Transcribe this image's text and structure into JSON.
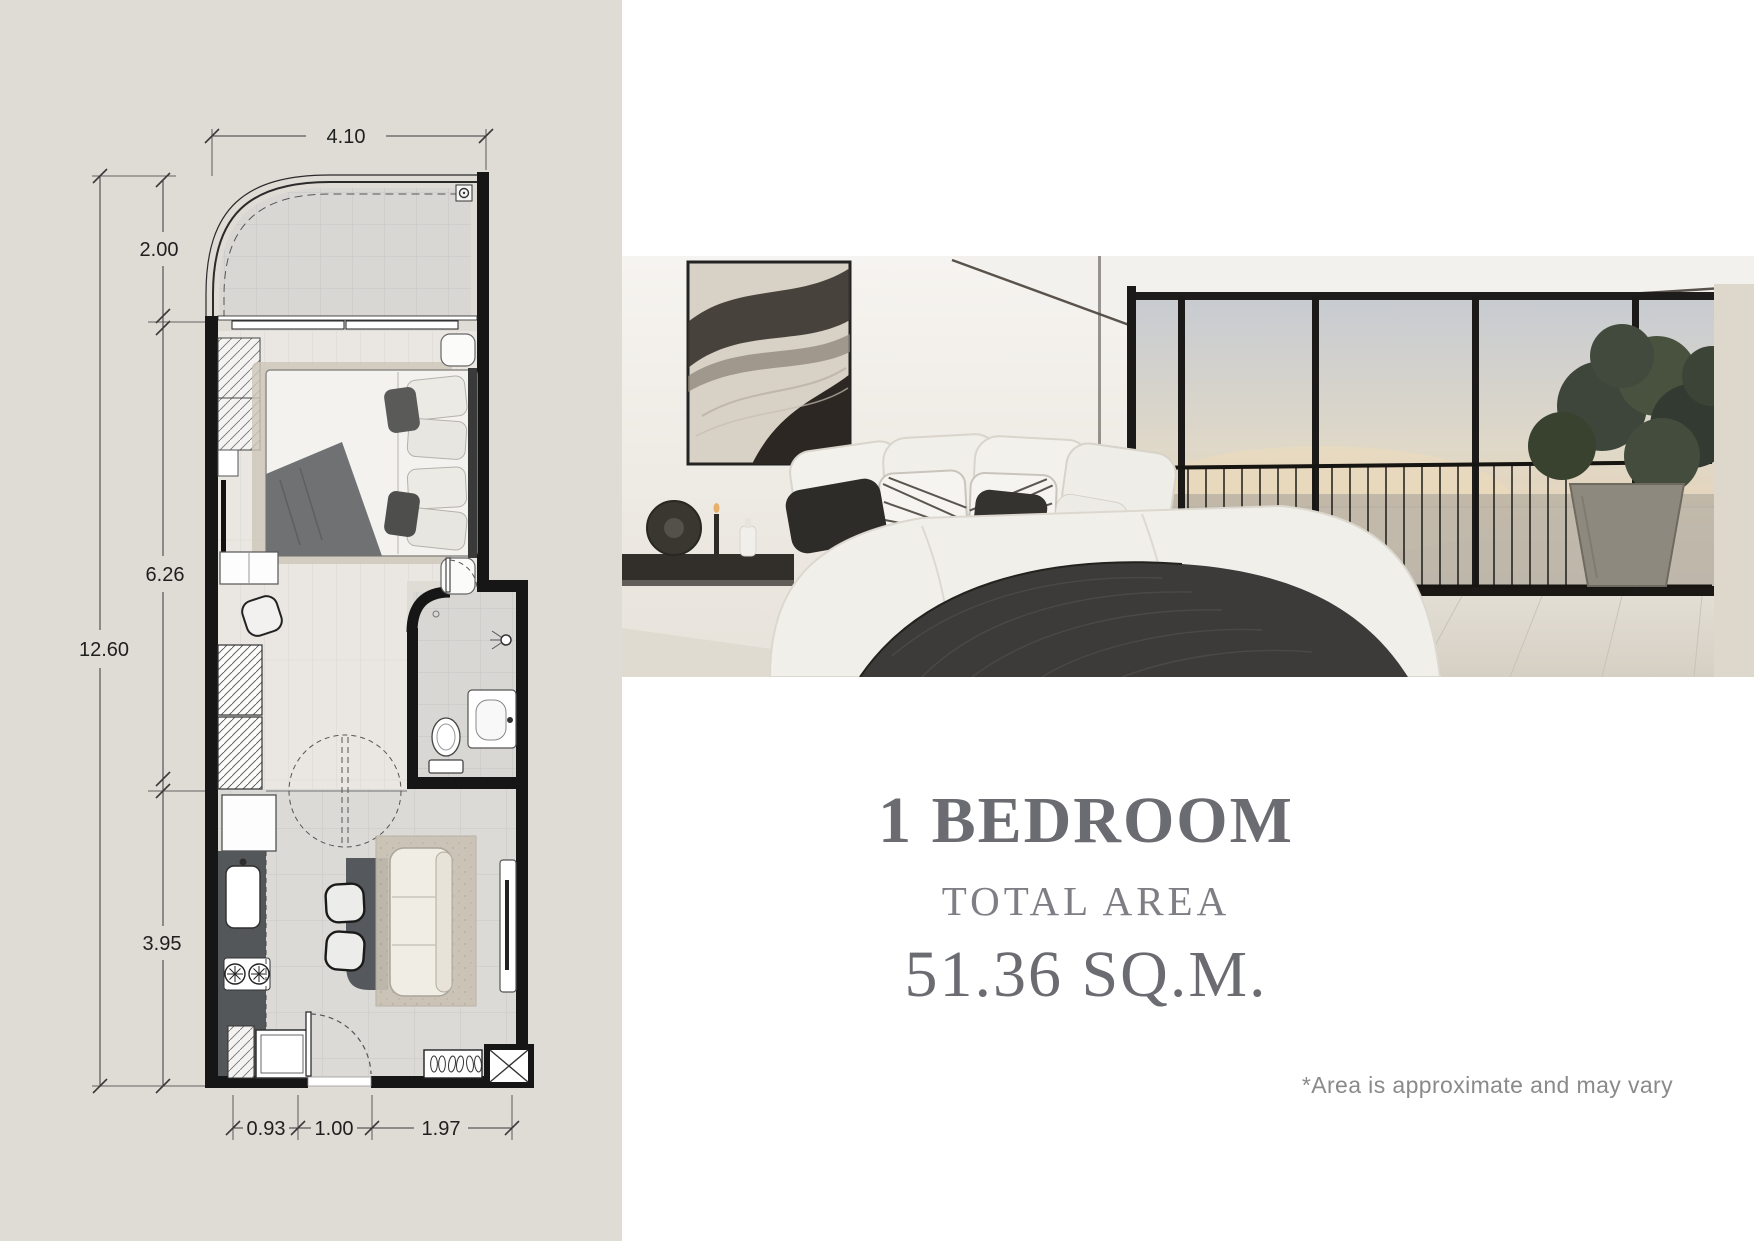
{
  "panel": {
    "bg": "#dfdbd5"
  },
  "plan": {
    "dims": {
      "top": "4.10",
      "total_height": "12.60",
      "balcony_depth": "2.00",
      "bedroom_depth": "6.26",
      "living_depth": "3.95",
      "bottom_a": "0.93",
      "bottom_b": "1.00",
      "bottom_c": "1.97"
    }
  },
  "info": {
    "title": "1 BEDROOM",
    "subtitle": "TOTAL AREA",
    "area": "51.36 SQ.M.",
    "disclaimer": "*Area is approximate and may vary"
  },
  "colors": {
    "headline": "#6b6b72",
    "subtitle": "#7e7e85",
    "disclaimer": "#8a8a8a",
    "panel_bg": "#dfdbd5",
    "wall": "#161616"
  },
  "icons": [
    "ac-unit-icon",
    "bed-icon",
    "pillow-icon",
    "nightstand-icon",
    "wardrobe-icon",
    "tv-icon",
    "desk-icon",
    "chair-icon",
    "door-swing-icon",
    "toilet-icon",
    "sink-icon",
    "shower-icon",
    "kitchen-counter-icon",
    "stove-icon",
    "washer-icon",
    "dining-table-icon",
    "sofa-icon",
    "rug-icon",
    "shoe-cabinet-icon",
    "shaft-icon",
    "artwork-icon",
    "console-icon",
    "window-icon",
    "railing-icon",
    "plant-icon"
  ]
}
